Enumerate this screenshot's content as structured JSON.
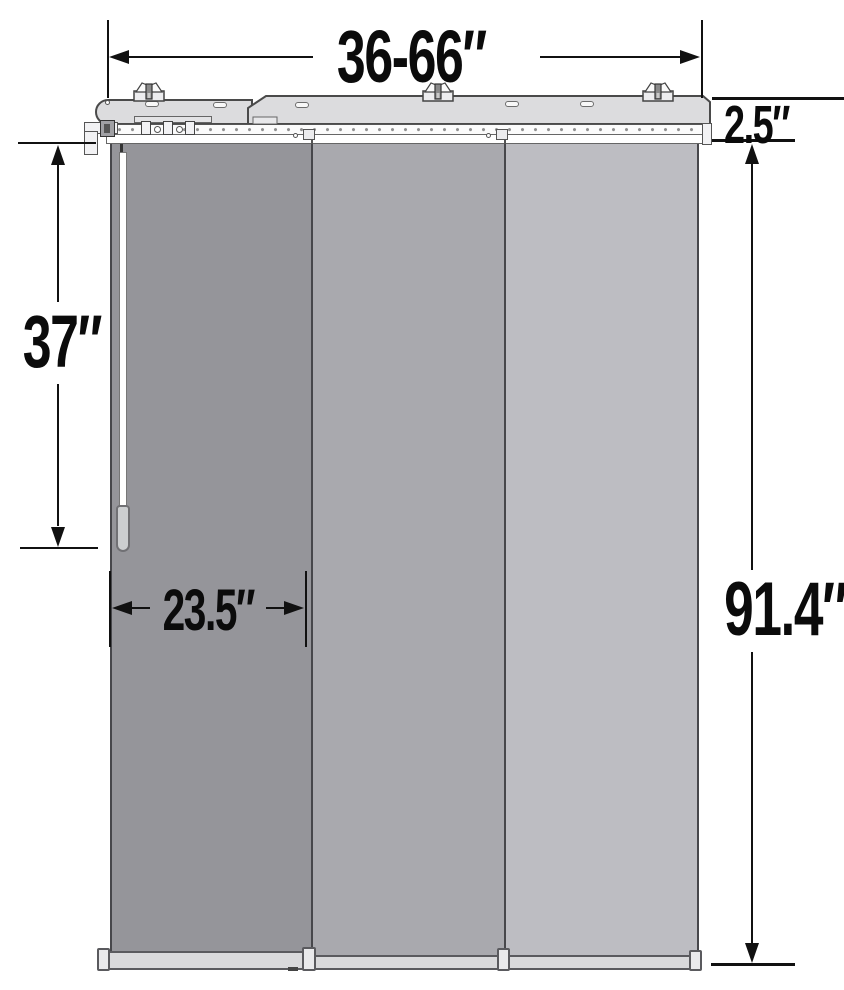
{
  "figure": {
    "kind": "product-dimension-diagram",
    "labels": {
      "width_range": "36-66″",
      "headrail_depth": "2.5″",
      "wand_length": "37″",
      "panel_width": "23.5″",
      "overall_height": "91.4″"
    },
    "counts": {
      "panels": 3,
      "mounting_brackets": 3
    },
    "colors": {
      "front_panel": "#95959a",
      "middle_panel": "#a9a9ae",
      "back_panel": "#bdbdc2",
      "hardware": "#dcdcde",
      "outline": "#47474b",
      "dimension_lines": "#111111",
      "background": "#ffffff"
    }
  }
}
